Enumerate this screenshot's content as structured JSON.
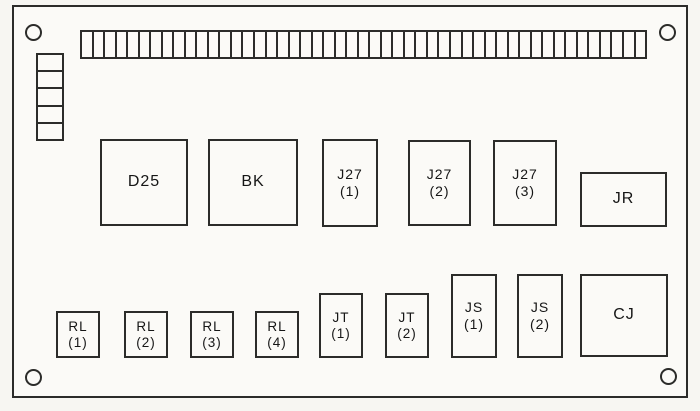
{
  "panel": {
    "type": "component-location-diagram",
    "background_color": "#fbfaf7",
    "line_color": "#2c2c2a",
    "mounting_holes": [
      "top-left",
      "top-right",
      "bottom-left",
      "bottom-right"
    ],
    "terminal_strip": {
      "teeth": 49
    },
    "edge_connector": {
      "cells": 5
    },
    "components": [
      {
        "id": "D25",
        "lines": [
          "D25"
        ]
      },
      {
        "id": "BK",
        "lines": [
          "BK"
        ]
      },
      {
        "id": "J27-1",
        "lines": [
          "J27",
          "(1)"
        ]
      },
      {
        "id": "J27-2",
        "lines": [
          "J27",
          "(2)"
        ]
      },
      {
        "id": "J27-3",
        "lines": [
          "J27",
          "(3)"
        ]
      },
      {
        "id": "JR",
        "lines": [
          "JR"
        ]
      },
      {
        "id": "RL-1",
        "lines": [
          "RL",
          "(1)"
        ]
      },
      {
        "id": "RL-2",
        "lines": [
          "RL",
          "(2)"
        ]
      },
      {
        "id": "RL-3",
        "lines": [
          "RL",
          "(3)"
        ]
      },
      {
        "id": "RL-4",
        "lines": [
          "RL",
          "(4)"
        ]
      },
      {
        "id": "JT-1",
        "lines": [
          "JT",
          "(1)"
        ]
      },
      {
        "id": "JT-2",
        "lines": [
          "JT",
          "(2)"
        ]
      },
      {
        "id": "JS-1",
        "lines": [
          "JS",
          "(1)"
        ]
      },
      {
        "id": "JS-2",
        "lines": [
          "JS",
          "(2)"
        ]
      },
      {
        "id": "CJ",
        "lines": [
          "CJ"
        ]
      }
    ]
  }
}
